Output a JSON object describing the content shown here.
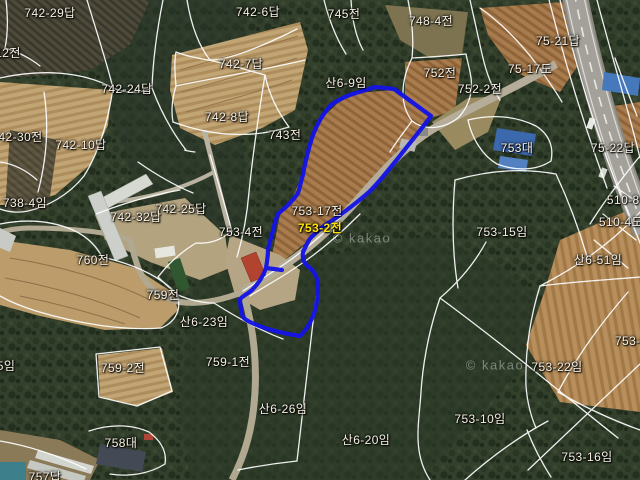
{
  "map": {
    "kind": "cadastral-parcel-map-over-satellite",
    "selected_parcel": "753-2전",
    "colors": {
      "boundary_line": "#ffffff",
      "selection_outline": "#1414e6",
      "selected_label": "#ffe600",
      "label": "#f7f1e3"
    },
    "watermarks": [
      {
        "text": "© kakao",
        "x": 362,
        "y": 238
      },
      {
        "text": "© kakao",
        "x": 495,
        "y": 365
      }
    ],
    "parcels": [
      {
        "label": "742-29답",
        "x": 50,
        "y": 13
      },
      {
        "label": "742-6답",
        "x": 258,
        "y": 12
      },
      {
        "label": "745전",
        "x": 344,
        "y": 14
      },
      {
        "label": "748-4전",
        "x": 431,
        "y": 21
      },
      {
        "label": "75-21답",
        "x": 558,
        "y": 41
      },
      {
        "label": "12전",
        "x": 8,
        "y": 53
      },
      {
        "label": "742-7답",
        "x": 241,
        "y": 64
      },
      {
        "label": "75-17도",
        "x": 530,
        "y": 69
      },
      {
        "label": "752전",
        "x": 440,
        "y": 73
      },
      {
        "label": "산6-9임",
        "x": 346,
        "y": 83
      },
      {
        "label": "742-24답",
        "x": 127,
        "y": 89
      },
      {
        "label": "752-2전",
        "x": 480,
        "y": 89
      },
      {
        "label": "742-8답",
        "x": 227,
        "y": 117
      },
      {
        "label": "743전",
        "x": 285,
        "y": 135
      },
      {
        "label": "742-30전",
        "x": 17,
        "y": 137
      },
      {
        "label": "742-10답",
        "x": 81,
        "y": 145
      },
      {
        "label": "753대",
        "x": 517,
        "y": 148
      },
      {
        "label": "75-22답",
        "x": 613,
        "y": 148
      },
      {
        "label": "738-4임",
        "x": 25,
        "y": 203
      },
      {
        "label": "510-8전",
        "x": 629,
        "y": 200
      },
      {
        "label": "742-25답",
        "x": 181,
        "y": 209
      },
      {
        "label": "753-17전",
        "x": 317,
        "y": 211
      },
      {
        "label": "742-32답",
        "x": 136,
        "y": 217
      },
      {
        "label": "510-4도",
        "x": 621,
        "y": 222
      },
      {
        "label": "753-2전",
        "x": 320,
        "y": 228,
        "selected": true
      },
      {
        "label": "753-4전",
        "x": 241,
        "y": 232
      },
      {
        "label": "753-15임",
        "x": 502,
        "y": 232
      },
      {
        "label": "760전",
        "x": 93,
        "y": 260
      },
      {
        "label": "산6-51임",
        "x": 598,
        "y": 260
      },
      {
        "label": "759전",
        "x": 163,
        "y": 295
      },
      {
        "label": "산6-23임",
        "x": 204,
        "y": 322
      },
      {
        "label": "5임",
        "x": 6,
        "y": 366
      },
      {
        "label": "759-1전",
        "x": 228,
        "y": 362
      },
      {
        "label": "759-2전",
        "x": 123,
        "y": 368
      },
      {
        "label": "753-9임",
        "x": 637,
        "y": 341
      },
      {
        "label": "753-22임",
        "x": 557,
        "y": 367
      },
      {
        "label": "산6-26임",
        "x": 283,
        "y": 409
      },
      {
        "label": "753-10임",
        "x": 480,
        "y": 419
      },
      {
        "label": "산6-20임",
        "x": 366,
        "y": 440
      },
      {
        "label": "758대",
        "x": 121,
        "y": 443
      },
      {
        "label": "753-16임",
        "x": 587,
        "y": 457
      },
      {
        "label": "757답",
        "x": 45,
        "y": 477
      }
    ]
  }
}
